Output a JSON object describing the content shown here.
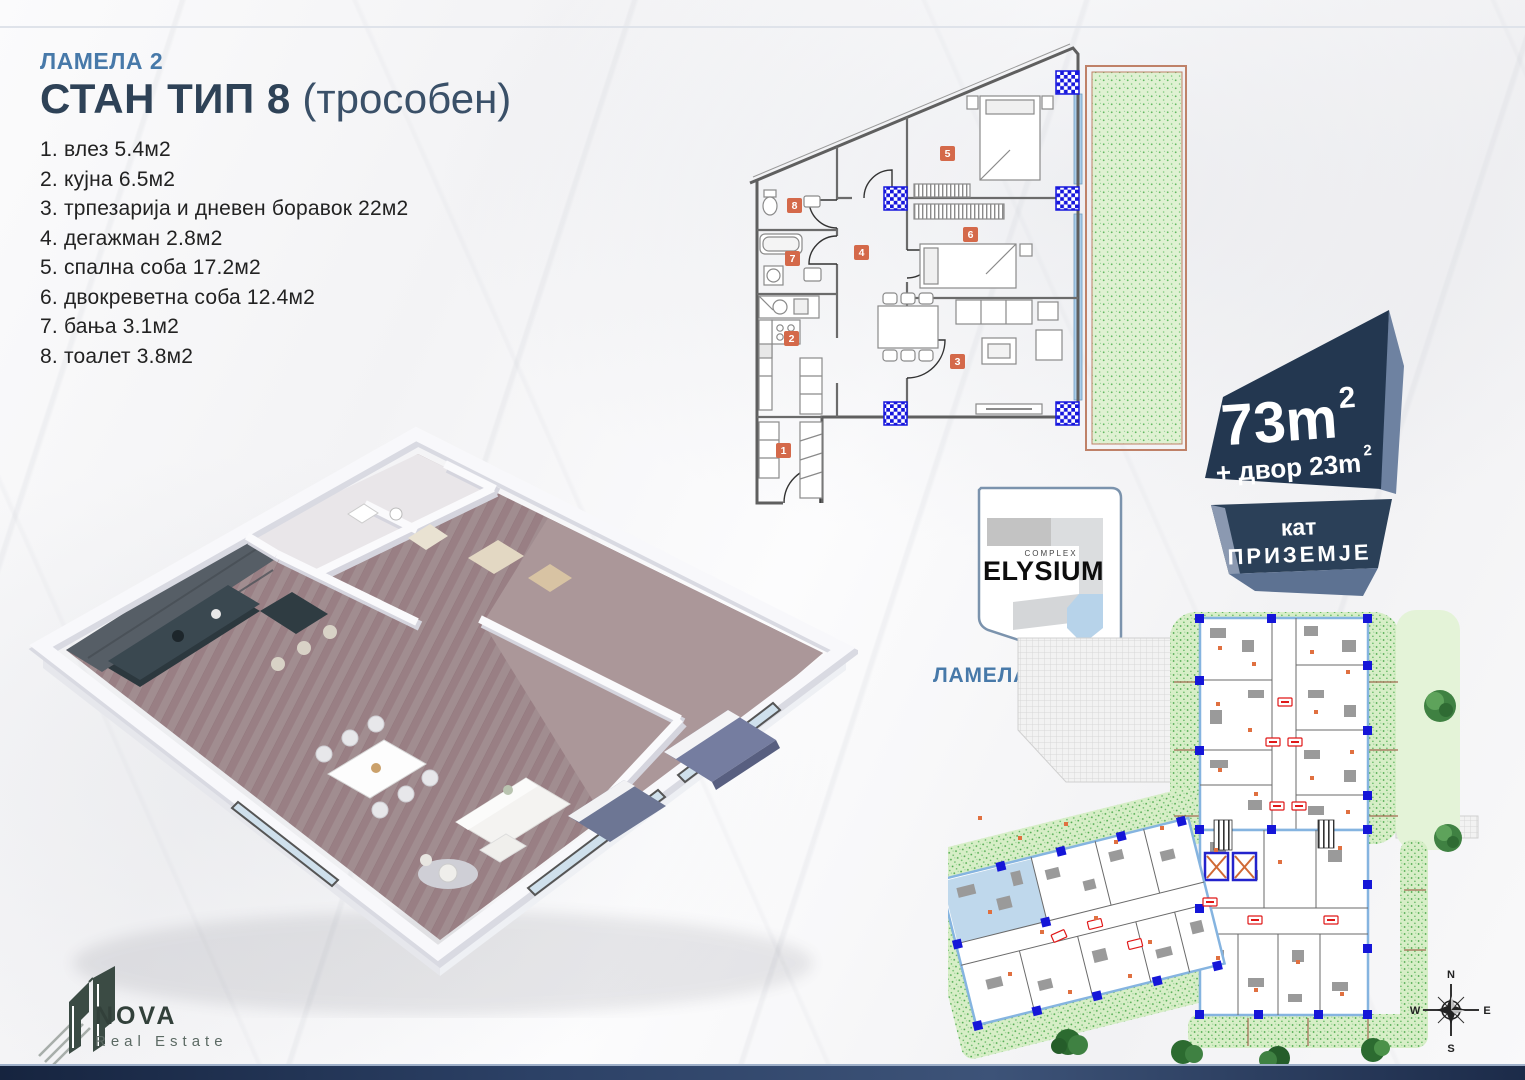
{
  "header": {
    "lamela": "ЛАМЕЛА 2",
    "title": "СТАН ТИП 8",
    "title_suffix": " (трособен)"
  },
  "rooms": [
    "1. влез 5.4м2",
    "2. кујна 6.5м2",
    "3. трпезарија и дневен боравок 22м2",
    "4. дегажман 2.8м2",
    "5. спална соба 17.2м2",
    "6. двокреветна соба 12.4м2",
    "7. бања 3.1м2",
    "8. тоалет 3.8м2"
  ],
  "badge": {
    "area": "73m",
    "area_sup": "2",
    "yard": "+ двор 23m",
    "yard_sup": "2",
    "floor_label": "кат",
    "floor_value": "ПРИЗЕМЈЕ"
  },
  "elysium": {
    "complex": "COMPLEX",
    "name": "ELYSIUM",
    "lamela": "ЛАМЕЛА 2"
  },
  "plan": {
    "markers": [
      "1",
      "2",
      "3",
      "4",
      "5",
      "6",
      "7",
      "8"
    ]
  },
  "compass": {
    "n": "N",
    "e": "E",
    "s": "S",
    "w": "W"
  },
  "nova": {
    "name": "NOVA",
    "tagline": "Real Estate"
  },
  "colors": {
    "accent_blue": "#4779a9",
    "title_navy": "#2e4257",
    "badge_navy": "#233750",
    "badge_facet": "#6e82a1",
    "column_blue": "#1717dd",
    "marker_orange": "#d4694a",
    "garden_green": "#dff1d2",
    "garden_border": "#bf8168",
    "window_blue": "#aacdea",
    "site_highlight": "#b8d4ea",
    "unit_red": "#e02020",
    "nova_green": "#3b4b44"
  }
}
